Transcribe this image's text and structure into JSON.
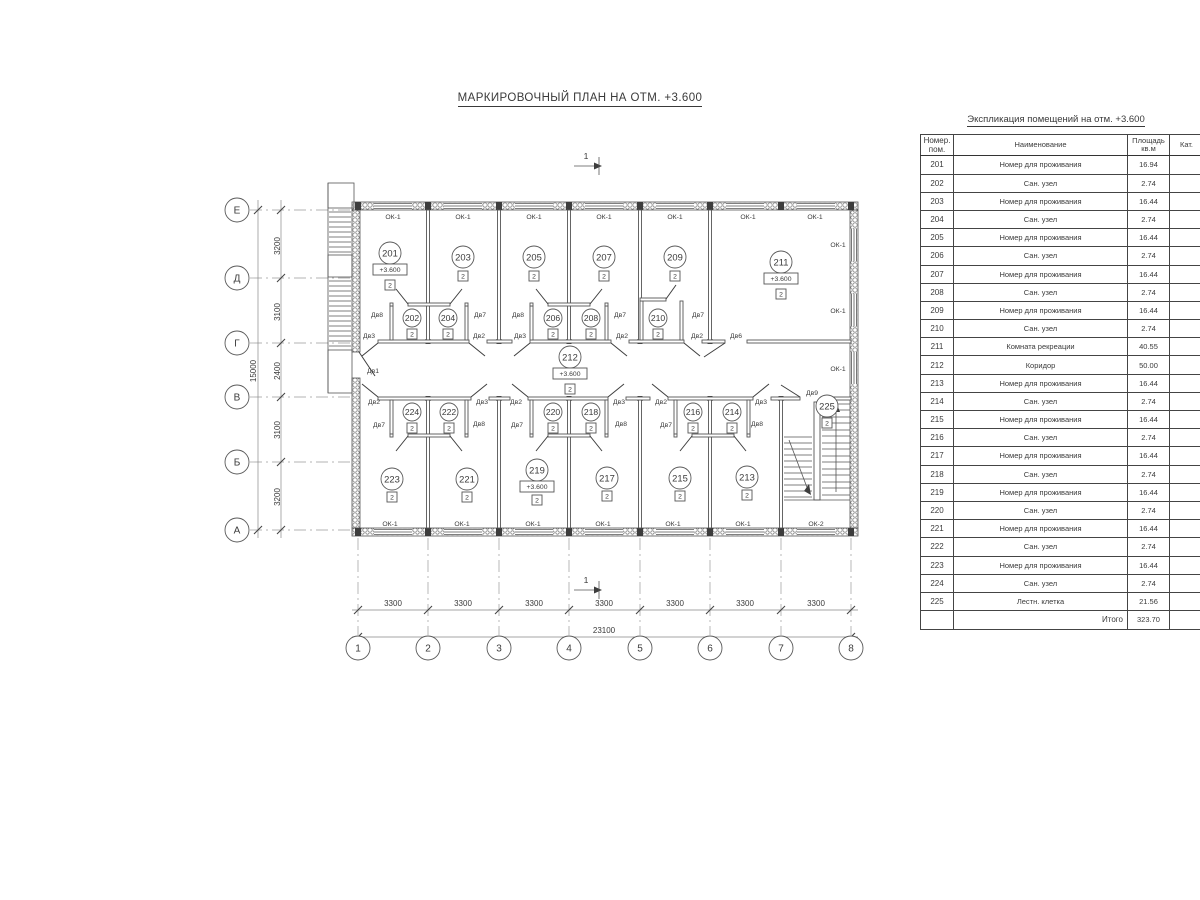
{
  "drawing_title": "МАРКИРОВОЧНЫЙ ПЛАН НА ОТМ. +3.600",
  "schedule": {
    "title": "Экспликация помещений на отм. +3.600",
    "columns": {
      "num": "Номер. пом.",
      "name": "Наименование",
      "area": "Площадь кв.м",
      "cat": "Кат."
    },
    "rows": [
      {
        "num": "201",
        "name": "Номер для проживания",
        "area": "16.94",
        "cat": ""
      },
      {
        "num": "202",
        "name": "Сан. узел",
        "area": "2.74",
        "cat": ""
      },
      {
        "num": "203",
        "name": "Номер для проживания",
        "area": "16.44",
        "cat": ""
      },
      {
        "num": "204",
        "name": "Сан. узел",
        "area": "2.74",
        "cat": ""
      },
      {
        "num": "205",
        "name": "Номер для проживания",
        "area": "16.44",
        "cat": ""
      },
      {
        "num": "206",
        "name": "Сан. узел",
        "area": "2.74",
        "cat": ""
      },
      {
        "num": "207",
        "name": "Номер для проживания",
        "area": "16.44",
        "cat": ""
      },
      {
        "num": "208",
        "name": "Сан. узел",
        "area": "2.74",
        "cat": ""
      },
      {
        "num": "209",
        "name": "Номер для проживания",
        "area": "16.44",
        "cat": ""
      },
      {
        "num": "210",
        "name": "Сан. узел",
        "area": "2.74",
        "cat": ""
      },
      {
        "num": "211",
        "name": "Комната рекреации",
        "area": "40.55",
        "cat": ""
      },
      {
        "num": "212",
        "name": "Коридор",
        "area": "50.00",
        "cat": ""
      },
      {
        "num": "213",
        "name": "Номер для проживания",
        "area": "16.44",
        "cat": ""
      },
      {
        "num": "214",
        "name": "Сан. узел",
        "area": "2.74",
        "cat": ""
      },
      {
        "num": "215",
        "name": "Номер для проживания",
        "area": "16.44",
        "cat": ""
      },
      {
        "num": "216",
        "name": "Сан. узел",
        "area": "2.74",
        "cat": ""
      },
      {
        "num": "217",
        "name": "Номер для проживания",
        "area": "16.44",
        "cat": ""
      },
      {
        "num": "218",
        "name": "Сан. узел",
        "area": "2.74",
        "cat": ""
      },
      {
        "num": "219",
        "name": "Номер для проживания",
        "area": "16.44",
        "cat": ""
      },
      {
        "num": "220",
        "name": "Сан. узел",
        "area": "2.74",
        "cat": ""
      },
      {
        "num": "221",
        "name": "Номер для проживания",
        "area": "16.44",
        "cat": ""
      },
      {
        "num": "222",
        "name": "Сан. узел",
        "area": "2.74",
        "cat": ""
      },
      {
        "num": "223",
        "name": "Номер для проживания",
        "area": "16.44",
        "cat": ""
      },
      {
        "num": "224",
        "name": "Сан. узел",
        "area": "2.74",
        "cat": ""
      },
      {
        "num": "225",
        "name": "Лестн. клетка",
        "area": "21.56",
        "cat": ""
      }
    ],
    "total_label": "Итого",
    "total_area": "323.70"
  },
  "plan": {
    "axis_letters": [
      "Е",
      "Д",
      "Г",
      "В",
      "Б",
      "А"
    ],
    "axis_numbers": [
      "1",
      "2",
      "3",
      "4",
      "5",
      "6",
      "7",
      "8"
    ],
    "dims_vertical": [
      "3200",
      "3100",
      "2400",
      "3100",
      "3200"
    ],
    "dim_vertical_total": "15000",
    "dims_horizontal": [
      "3300",
      "3300",
      "3300",
      "3300",
      "3300",
      "3300",
      "3300"
    ],
    "dim_horizontal_total": "23100",
    "section_mark": "1",
    "elevation_mark": "+3.600",
    "category_mark": "2",
    "window_type_1": "ОК-1",
    "window_type_2": "ОК-2",
    "door_types": {
      "d1": "Дв1",
      "d2": "Дв2",
      "d3": "Дв3",
      "d6": "Дв6",
      "d7": "Дв7",
      "d8": "Дв8",
      "d9": "Дв9"
    },
    "rooms": {
      "n201": "201",
      "n202": "202",
      "n203": "203",
      "n204": "204",
      "n205": "205",
      "n206": "206",
      "n207": "207",
      "n208": "208",
      "n209": "209",
      "n210": "210",
      "n211": "211",
      "n212": "212",
      "n213": "213",
      "n214": "214",
      "n215": "215",
      "n216": "216",
      "n217": "217",
      "n218": "218",
      "n219": "219",
      "n220": "220",
      "n221": "221",
      "n222": "222",
      "n223": "223",
      "n224": "224",
      "n225": "225"
    }
  }
}
